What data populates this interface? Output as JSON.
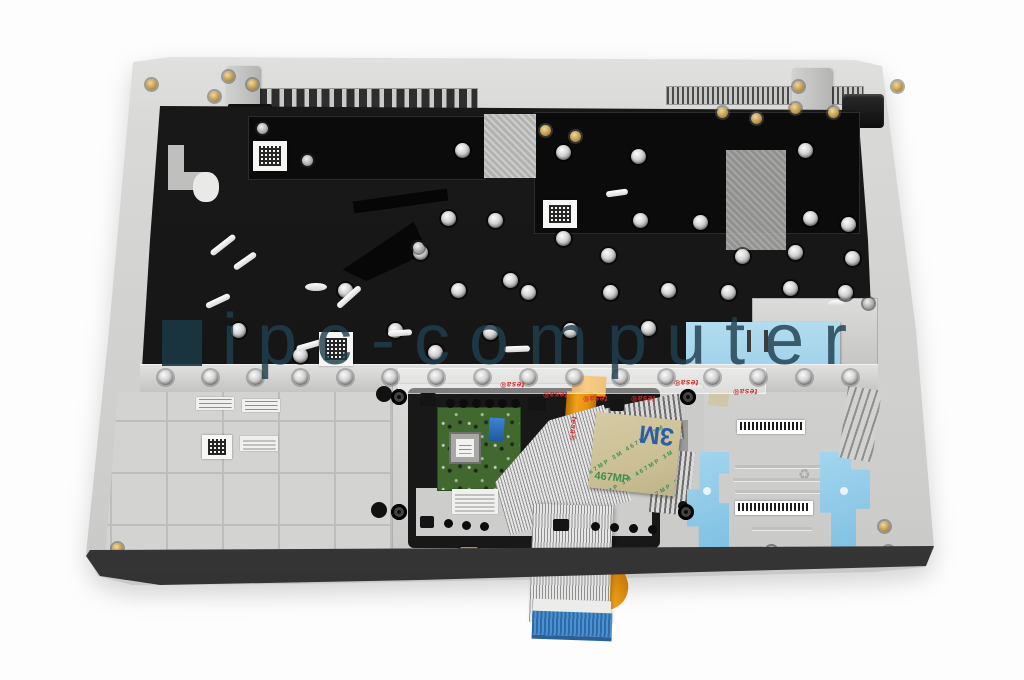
{
  "scene": {
    "type": "product-photo",
    "subject": "laptop palmrest keyboard assembly, inner view",
    "background": "#fdfdfd"
  },
  "watermark": {
    "text": "ipc-computer",
    "color": "#24485a"
  },
  "stickers": {
    "m3": {
      "brand": "3M",
      "code": "467MP",
      "diagonal": "467MP 3M 467MP 3M",
      "bg": "#cfc39a",
      "brand_color": "#2a5fa8",
      "code_color": "#3f8f4f"
    },
    "tesa": {
      "label": "tesa®",
      "color": "#cf2b2b"
    },
    "recycle_icon": "♻"
  },
  "colors": {
    "palmrest_silver": "#d6d6d4",
    "keyboard_plate_black": "#161616",
    "tape_blue": "#9fd2ea",
    "touchpad_pcb_green": "#41682f",
    "flex_cable_orange": "#e8920f",
    "connector_blue": "#3c7fc0",
    "front_rim_gray": "#3f3f3f",
    "gold_screw": "#c19a4e"
  }
}
